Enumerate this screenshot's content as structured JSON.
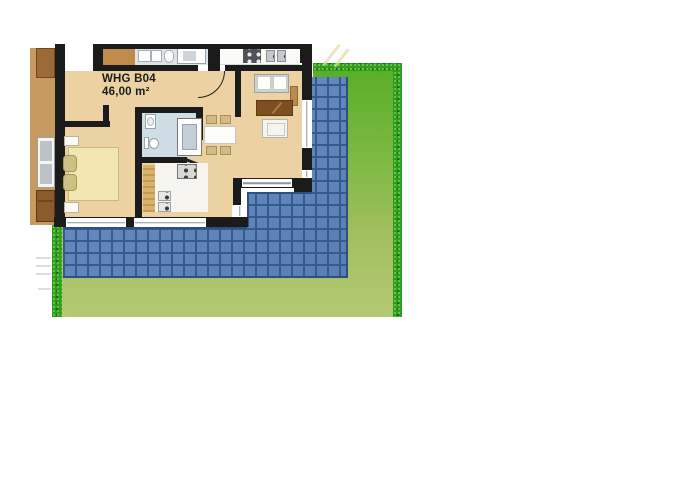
{
  "plan": {
    "unit_label": "WHG B04",
    "area_label": "46,00 m²"
  },
  "colors": {
    "wall": "#1b1b1b",
    "floor": "#ecd1a2",
    "bath-floor": "#cfdde5",
    "kitchen-floor": "#f6f5f0",
    "cabinet": "#d9b26c",
    "terrace-tile": "#5e86ba",
    "terrace-grout": "#365a90",
    "terrace-edge": "#2e4f82",
    "lawn-top": "#56ad27",
    "lawn-bottom": "#b3c973",
    "lawn-border": "#2f9e27",
    "speckle-light": "#7cd02f",
    "speckle-dark": "#15701c",
    "neighbor-floor": "#c79a62",
    "neighbor-furniture": "#9c6b35",
    "dresser": "#8d5a2b",
    "bed": "#f1e7b2",
    "bed-border": "#c8b97c",
    "pillow": "#cfc083",
    "bath-strip": "#dce2e6",
    "brown-room": "#bf8a4a",
    "counter": "#fafaf7",
    "stove-dark": "#4d5357",
    "chair": "#d2b988",
    "chair-border": "#ab8f55",
    "table": "#fcfcfa",
    "sofa": "#cfd3cf",
    "coffee-table": "#7d4e1f",
    "armchair": "#f4f4f0",
    "window-line": "#8b959b",
    "label": "#1c1c1c"
  }
}
